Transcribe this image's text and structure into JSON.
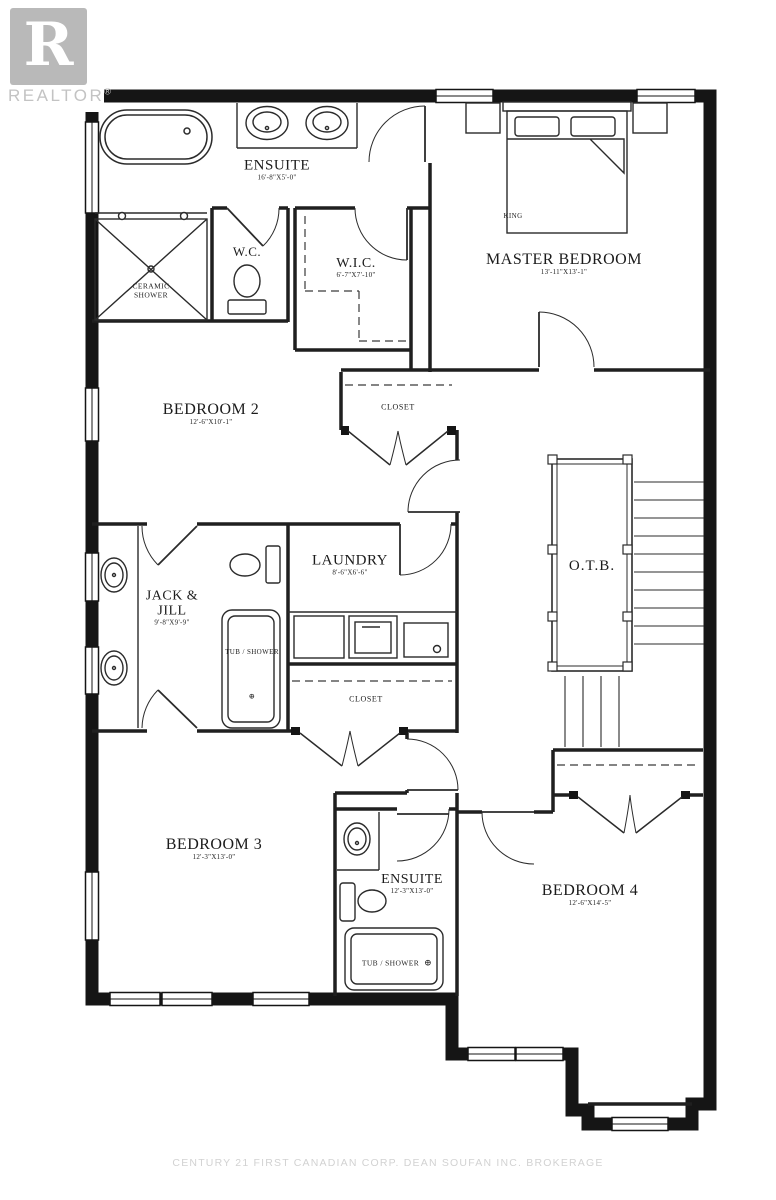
{
  "branding": {
    "logo_letter": "R",
    "logo_text": "REALTOR",
    "registered": "®"
  },
  "watermark": "CENTURY 21 FIRST CANADIAN CORP. DEAN SOUFAN INC. BROKERAGE",
  "rooms": [
    {
      "id": "ensuite-master",
      "label": "ENSUITE",
      "dims": "16'-8\"X5'-0\""
    },
    {
      "id": "wc",
      "label": "W.C.",
      "dims": ""
    },
    {
      "id": "wic",
      "label": "W.I.C.",
      "dims": "6'-7\"X7'-10\""
    },
    {
      "id": "master-bedroom",
      "label": "MASTER BEDROOM",
      "dims": "13'-11\"X13'-1\""
    },
    {
      "id": "bedroom-2",
      "label": "BEDROOM 2",
      "dims": "12'-6\"X10'-1\""
    },
    {
      "id": "closet-upper",
      "label": "CLOSET",
      "dims": ""
    },
    {
      "id": "laundry",
      "label": "LAUNDRY",
      "dims": "8'-6\"X6'-6\""
    },
    {
      "id": "jack-and-jill",
      "label": "JACK &",
      "label2": "JILL",
      "dims": "9'-8\"X9'-9\""
    },
    {
      "id": "otb",
      "label": "O.T.B.",
      "dims": ""
    },
    {
      "id": "closet-lower",
      "label": "CLOSET",
      "dims": ""
    },
    {
      "id": "bedroom-3",
      "label": "BEDROOM 3",
      "dims": "12'-3\"X13'-0\""
    },
    {
      "id": "ensuite-2",
      "label": "ENSUITE",
      "dims": "12'-3\"X13'-0\""
    },
    {
      "id": "bedroom-4",
      "label": "BEDROOM 4",
      "dims": "12'-6\"X14'-5\""
    }
  ],
  "fixtures": {
    "ceramic_shower_line1": "CERAMIC",
    "ceramic_shower_line2": "SHOWER",
    "tub_shower": "TUB / SHOWER",
    "tub_shower_symbol": "⊕",
    "king": "KING"
  },
  "colors": {
    "wall": "#151515",
    "logo_gray": "#b9b9b9",
    "watermark_gray": "#d2d2d2"
  }
}
